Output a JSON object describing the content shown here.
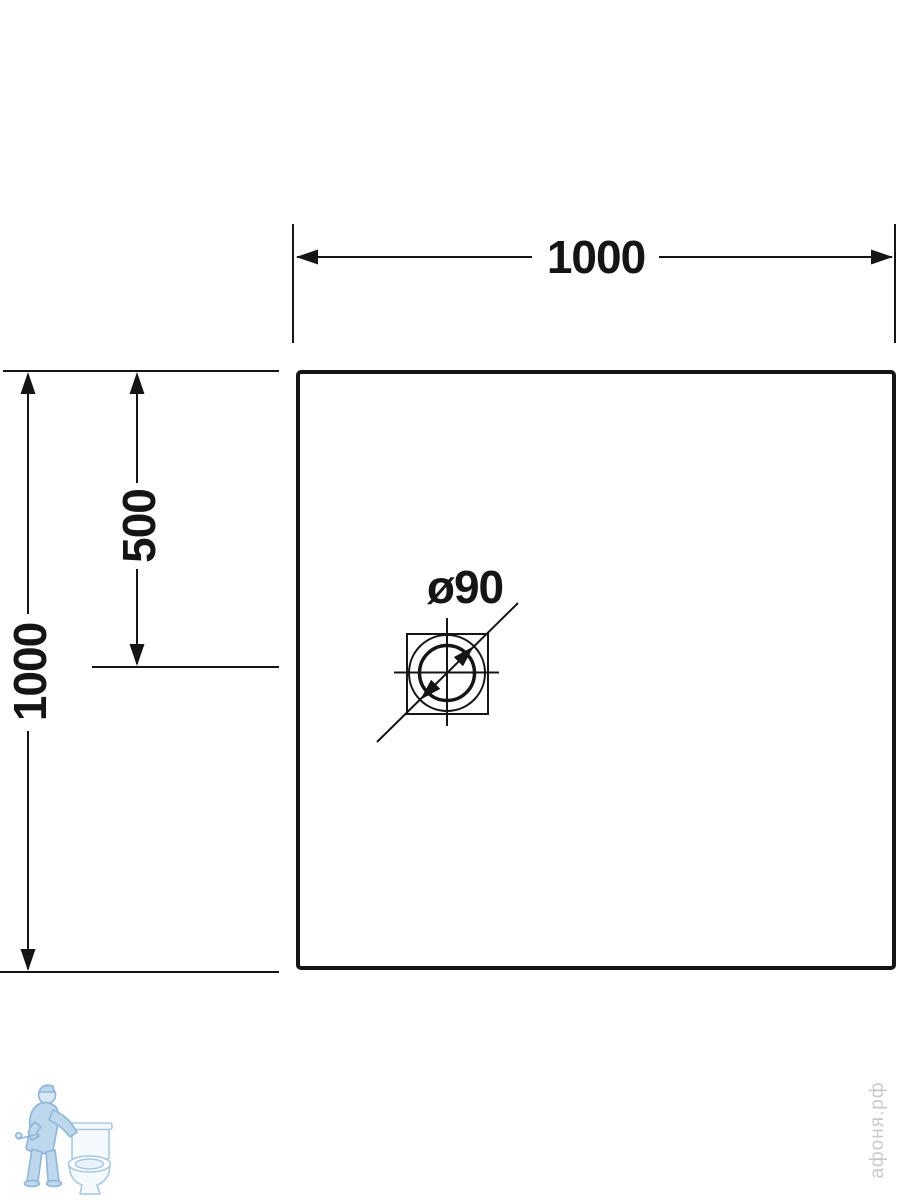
{
  "diagram": {
    "type": "technical-drawing",
    "subject": "square shower tray plan view with offset round drain",
    "dimensions": {
      "top_width": "1000",
      "left_height": "1000",
      "left_center_offset": "500",
      "drain_diameter": "ø90"
    },
    "colors": {
      "line": "#151515",
      "background": "#ffffff",
      "watermark_blue_fill": "#bdd7ec",
      "watermark_blue_stroke": "#8fb6d8",
      "watermark_text_gray": "#c9c9c9"
    }
  },
  "watermark": {
    "logo": "plumber-with-toilet",
    "site_text": "афоня.рф"
  }
}
